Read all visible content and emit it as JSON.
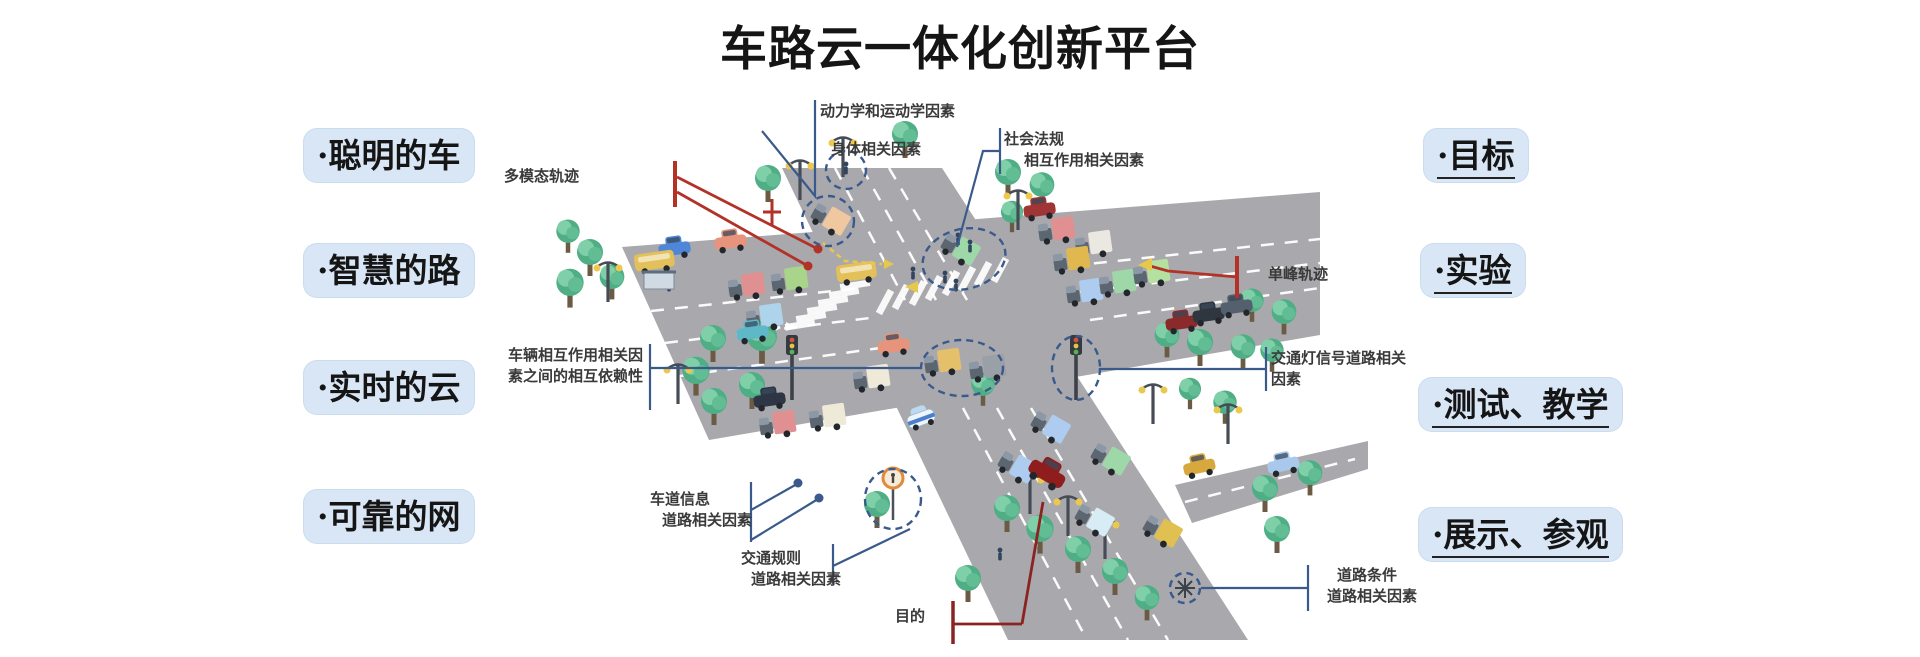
{
  "title": "车路云一体化创新平台",
  "left_labels": [
    {
      "text": "·聪明的车"
    },
    {
      "text": "·智慧的路"
    },
    {
      "text": "·实时的云"
    },
    {
      "text": "·可靠的网"
    }
  ],
  "right_labels": [
    {
      "text": "·目标"
    },
    {
      "text": "·实验"
    },
    {
      "text": "·测试、教学"
    },
    {
      "text": "·展示、参观"
    }
  ],
  "annotations": {
    "dynamics": "动力学和运动学因素",
    "body_factor": "身体相关因素",
    "social_line1": "社会法规",
    "social_line2": "相互作用相关因素",
    "multimodal": "多模态轨迹",
    "unimodal": "单峰轨迹",
    "interaction_line1": "车辆相互作用相关因",
    "interaction_line2": "素之间的相互依赖性",
    "traffic_light_line1": "交通灯信号道路相关",
    "traffic_light_line2": "因素",
    "lane_line1": "车道信息",
    "lane_line2": "道路相关因素",
    "rules_line1": "交通规则",
    "rules_line2": "道路相关因素",
    "condition_line1": "道路条件",
    "condition_line2": "道路相关因素",
    "purpose": "目的"
  },
  "colors": {
    "label_bg": "#d9e6f6",
    "callout_blue": "#3a5a8c",
    "callout_red": "#b23228",
    "callout_darkred": "#8b2323",
    "road_gray": "#a9a9ad",
    "tree_green": "#4fae85",
    "lane_marking": "#ffffff",
    "text_dark": "#151515",
    "annotation_text": "#3a3a3a",
    "highlight_yellow": "#e8c84a"
  }
}
